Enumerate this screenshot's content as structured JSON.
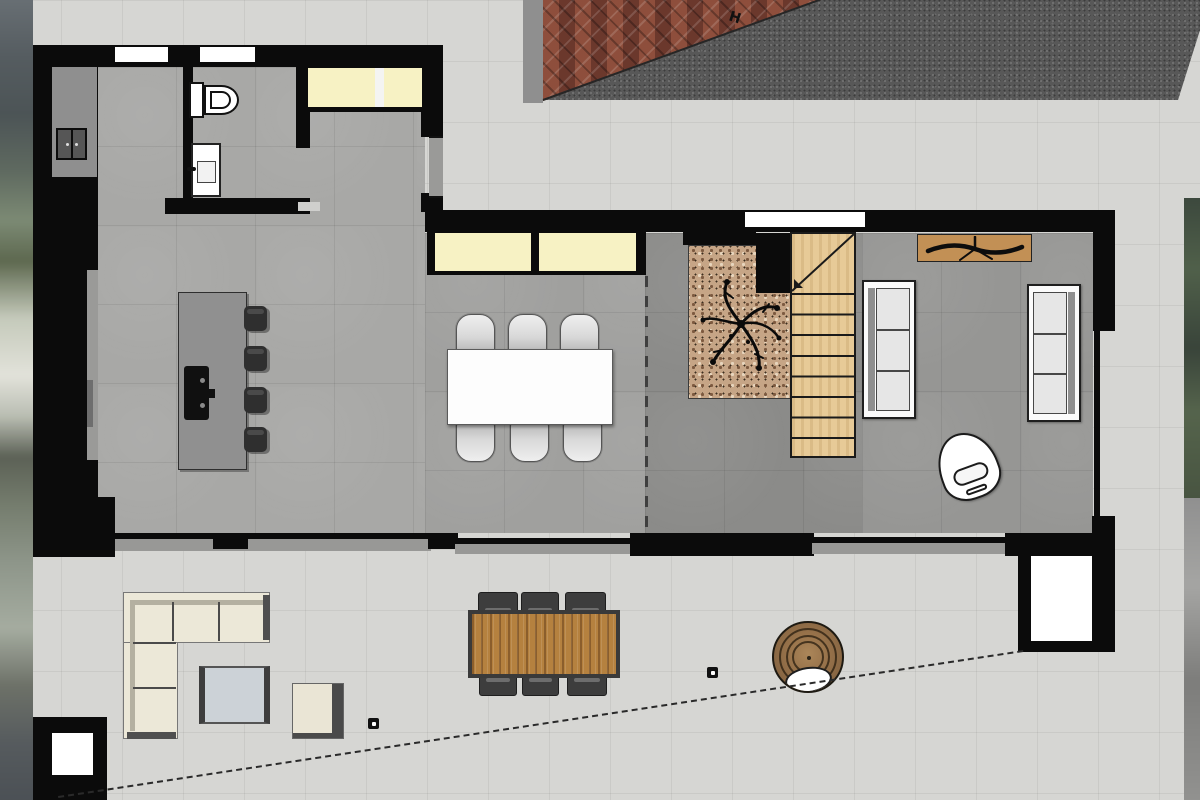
{
  "meta": {
    "title": "ground-floor-plan-render",
    "type": "floor-plan"
  },
  "markers": {
    "h": "H"
  },
  "colors": {
    "wall": "#0b0b0b",
    "paving": "#d6d6d3",
    "floorKitchen": "#a8a8a6",
    "floorMain": "#a0a09e",
    "floorHall": "#8b8b89",
    "floorLiving": "#969694",
    "glass": "#f7f2c4",
    "sill": "#989896",
    "stairWood": "#e7ca97",
    "consoleWood": "#c29055",
    "tableWood": "#b5813f",
    "brick": "#7c4336",
    "asphalt": "#585858",
    "concrete": "#8f8f8f",
    "planterGravel": "#c6a586",
    "hedge": "#45523f",
    "cream": "#ece8d8",
    "coffeeTable": "#ccd2d7"
  },
  "rooms": [
    "bathroom",
    "pantry",
    "kitchen",
    "dining-area",
    "stair-hall",
    "living-room",
    "terrace",
    "driveway"
  ],
  "furniture": [
    "toilet",
    "washbasin",
    "appliance",
    "kitchen-island",
    "cooktop",
    "bar-stool",
    "dining-table",
    "dining-chair",
    "indoor-planter",
    "staircase",
    "tv-console",
    "sofa",
    "armchair",
    "outdoor-corner-sofa",
    "coffee-table",
    "side-table",
    "outdoor-dining-table",
    "outdoor-chair",
    "fire-pit-table",
    "planter-box",
    "drain",
    "boundary-line"
  ]
}
